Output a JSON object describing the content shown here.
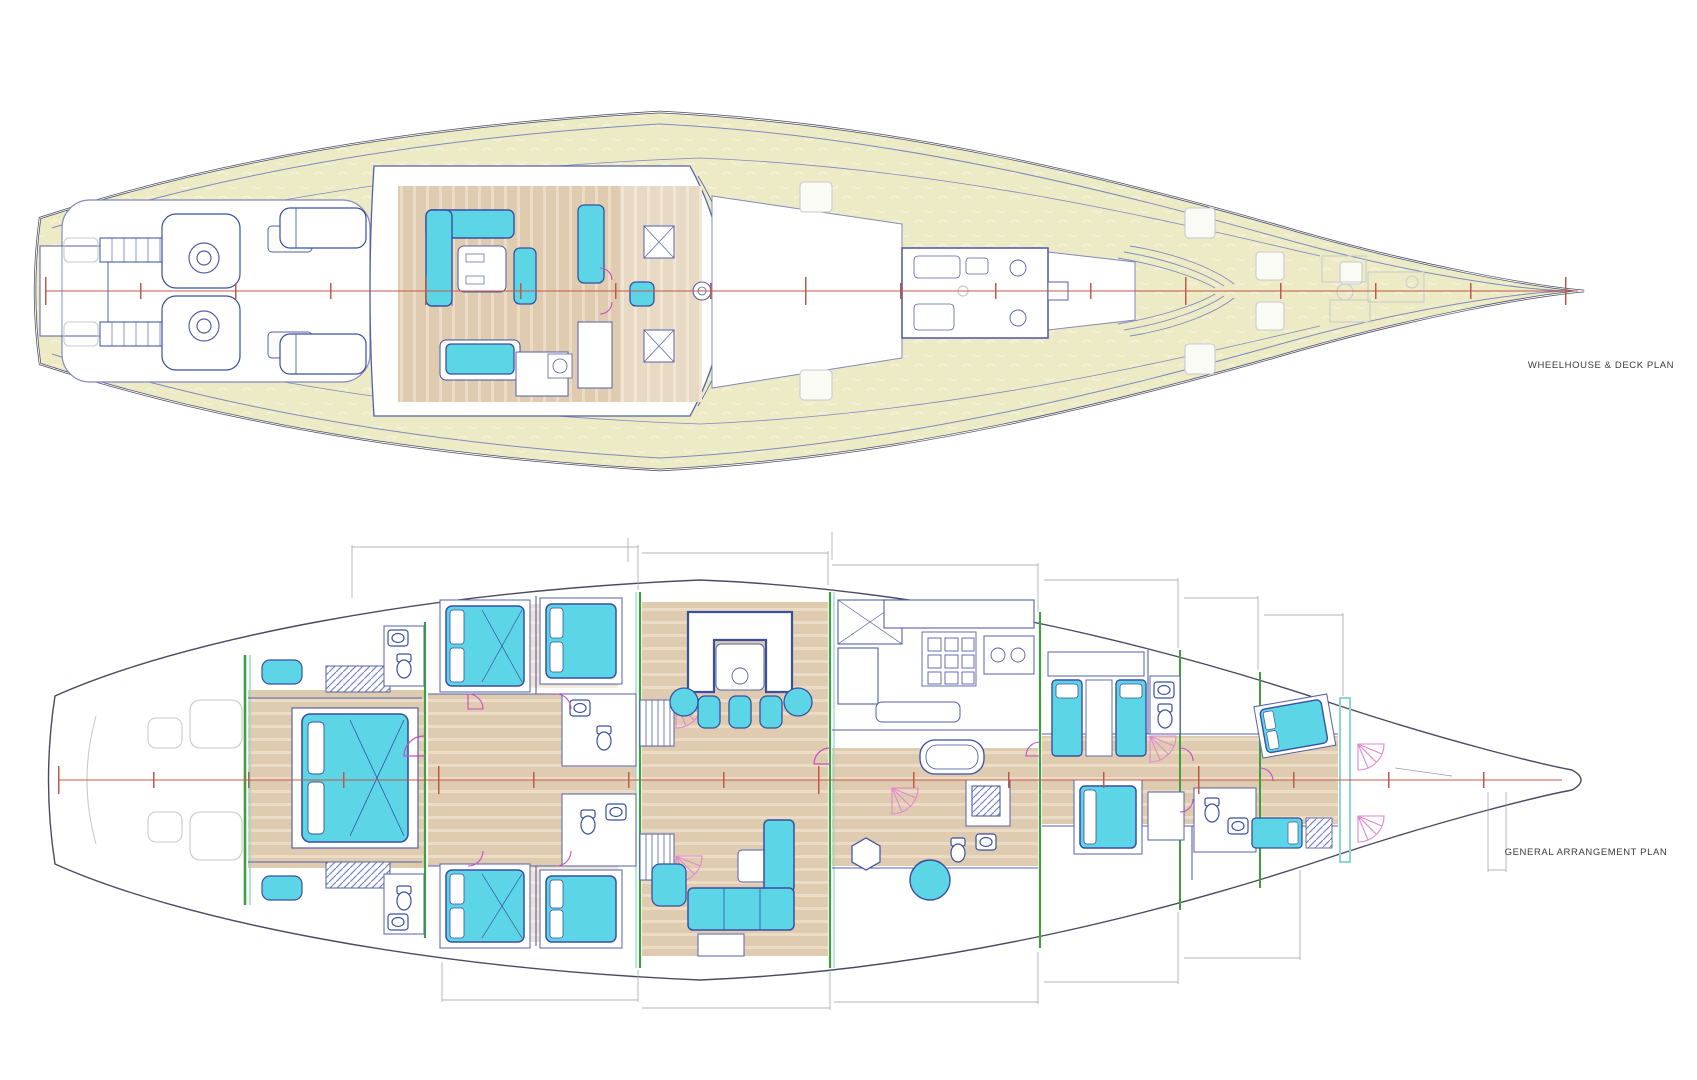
{
  "sheet": {
    "background": "#ffffff"
  },
  "plans": {
    "wheelhouse": {
      "title": "WHEELHOUSE & DECK PLAN"
    },
    "ga": {
      "title": "GENERAL ARRANGEMENT PLAN"
    }
  },
  "colors": {
    "paper": "#ffffff",
    "deck": "#ecebc6",
    "deckSquiggle": "#f5f4da",
    "hullLine": "#4a4a64",
    "innerLine": "#8288bc",
    "centerline": "#c05848",
    "wood": "#dfccb0",
    "woodStripe": "#ecdcc6",
    "cyan": "#5cd6e6",
    "furnLine": "#3a4fa0",
    "slate": "#5560a8",
    "wallGreen": "#3f9f3f",
    "teal": "#8fd6cf",
    "magenta": "#c44ec4",
    "pink": "#e387d3",
    "ghost": "#c9c9cf",
    "dim": "#9a9aa2",
    "title": "#3a3a3a"
  }
}
